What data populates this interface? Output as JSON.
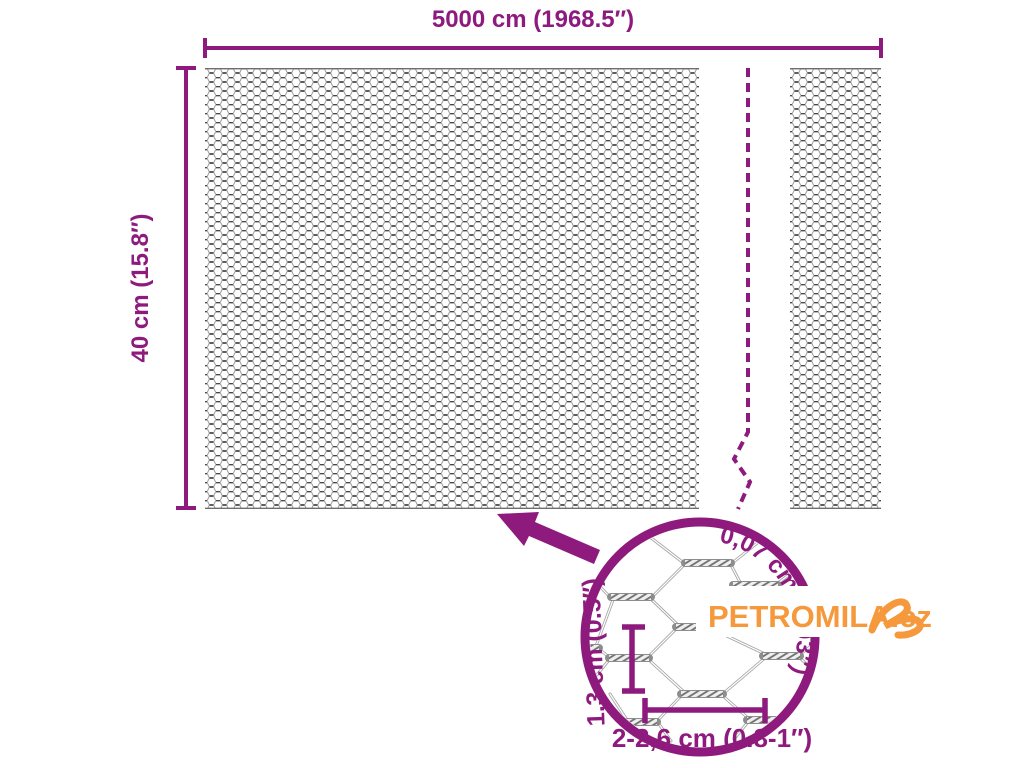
{
  "colors": {
    "purple": "#8e1a7e",
    "orange": "#f6993d"
  },
  "product_diagram": {
    "width_label": "5000 cm (1968.5″)",
    "height_label": "40 cm (15.8″)",
    "detail": {
      "wire_thickness_label": "0,07 cm (0.03″)",
      "mesh_height_label": "1,3 cm (0.5″)",
      "mesh_width_label": "2-2,6 cm (0.8-1″)"
    },
    "brand": {
      "logo_text": "PETROMILA.cz"
    }
  }
}
